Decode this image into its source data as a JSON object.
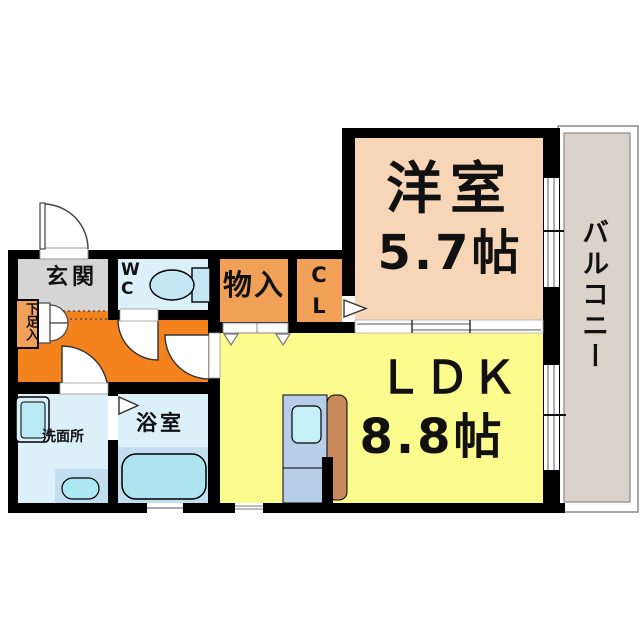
{
  "plan_title": "1LDK floor plan",
  "rooms": {
    "genkan": {
      "label": "玄関"
    },
    "wc": {
      "label": "W\nC"
    },
    "shoe_cabinet": {
      "label": "下足入"
    },
    "storage": {
      "label": "物入"
    },
    "closet": {
      "label": "C\nL"
    },
    "western_room": {
      "label": "洋室",
      "size": "5.7帖"
    },
    "ldk": {
      "label": "ＬＤＫ",
      "size": "8.8帖"
    },
    "washroom": {
      "label": "洗面所"
    },
    "bathroom": {
      "label": "浴室"
    },
    "balcony": {
      "label": "バルコニー"
    }
  },
  "colors": {
    "wall": "#000000",
    "genkan": "#d5d5d5",
    "hallway": "#f5831d",
    "storage_orange": "#f0a057",
    "water_room_blue": "#dcf0f9",
    "western_room_salmon": "#f6d6b6",
    "ldk_yellow": "#fcfc8e",
    "balcony_beige": "#dbd2ca",
    "fixture_blue": "#c5e7f5",
    "tub_blue": "#ade4f0",
    "panel_blue": "#c3ddf1",
    "sink_cyan": "#b9e9f2",
    "counter_blue": "#b7cee8",
    "cabinet_brown": "#c9895b"
  }
}
